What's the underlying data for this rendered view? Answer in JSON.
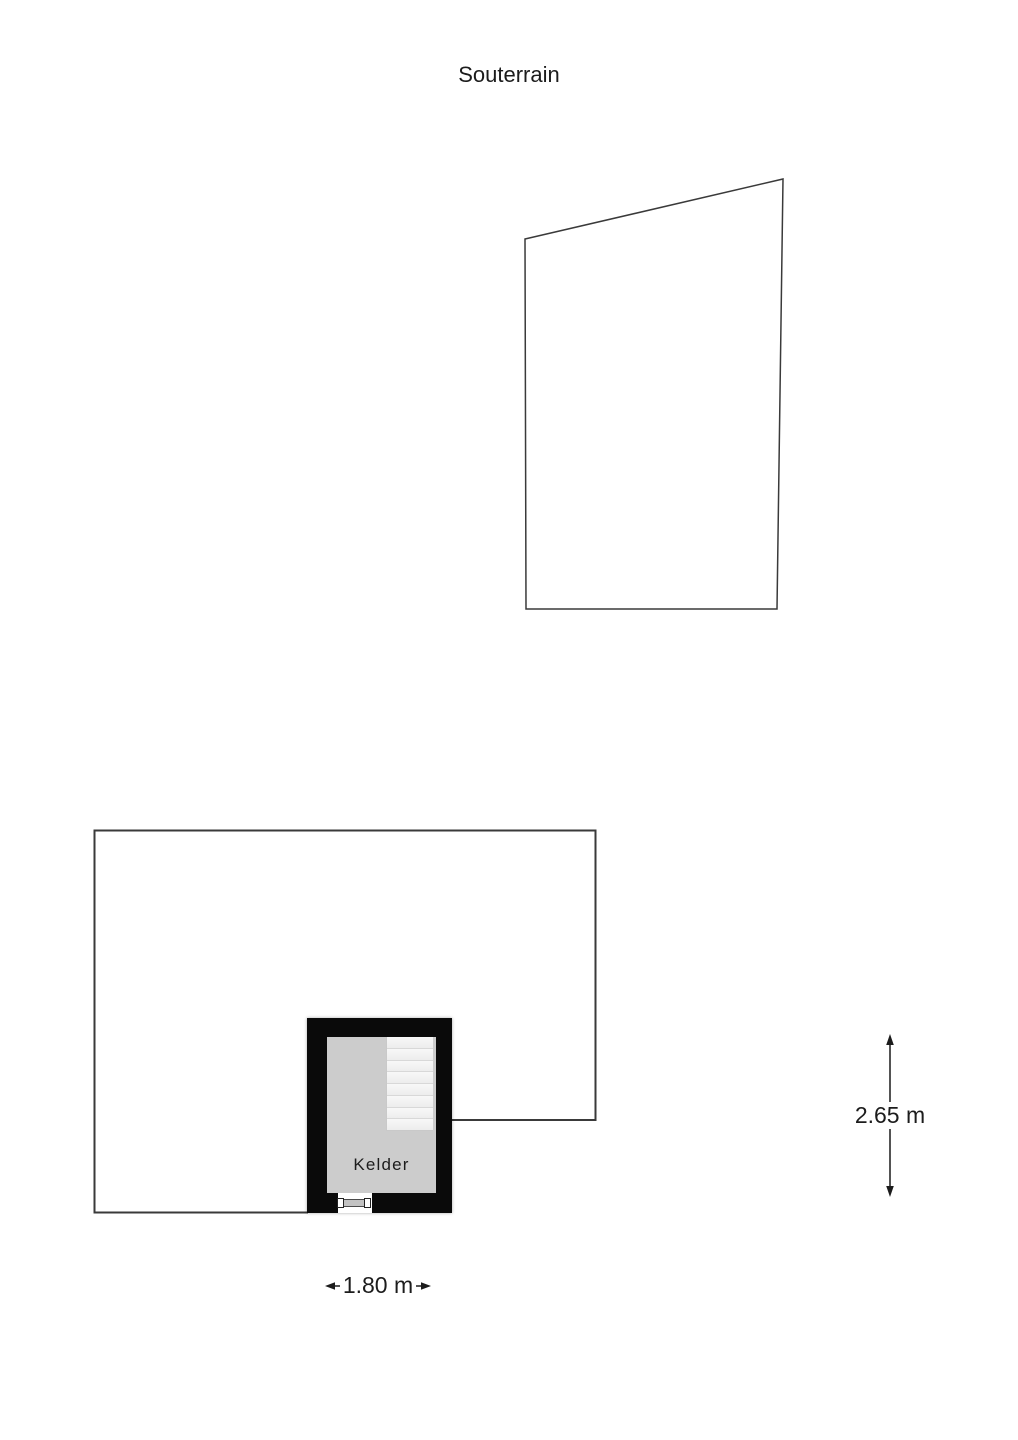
{
  "title": "Souterrain",
  "rooms": [
    {
      "label": "Kelder"
    }
  ],
  "dimensions": {
    "vertical": "2.65 m",
    "horizontal": "1.80 m"
  },
  "stairs": {
    "treads": 8
  },
  "colors": {
    "background": "#ffffff",
    "outline": "#3a3a3a",
    "wall": "#0a0a0a",
    "floor": "#cccccc",
    "stair_fill": "#f1f1f1",
    "stair_line": "#d8d8d8",
    "text": "#1c1c1c"
  }
}
